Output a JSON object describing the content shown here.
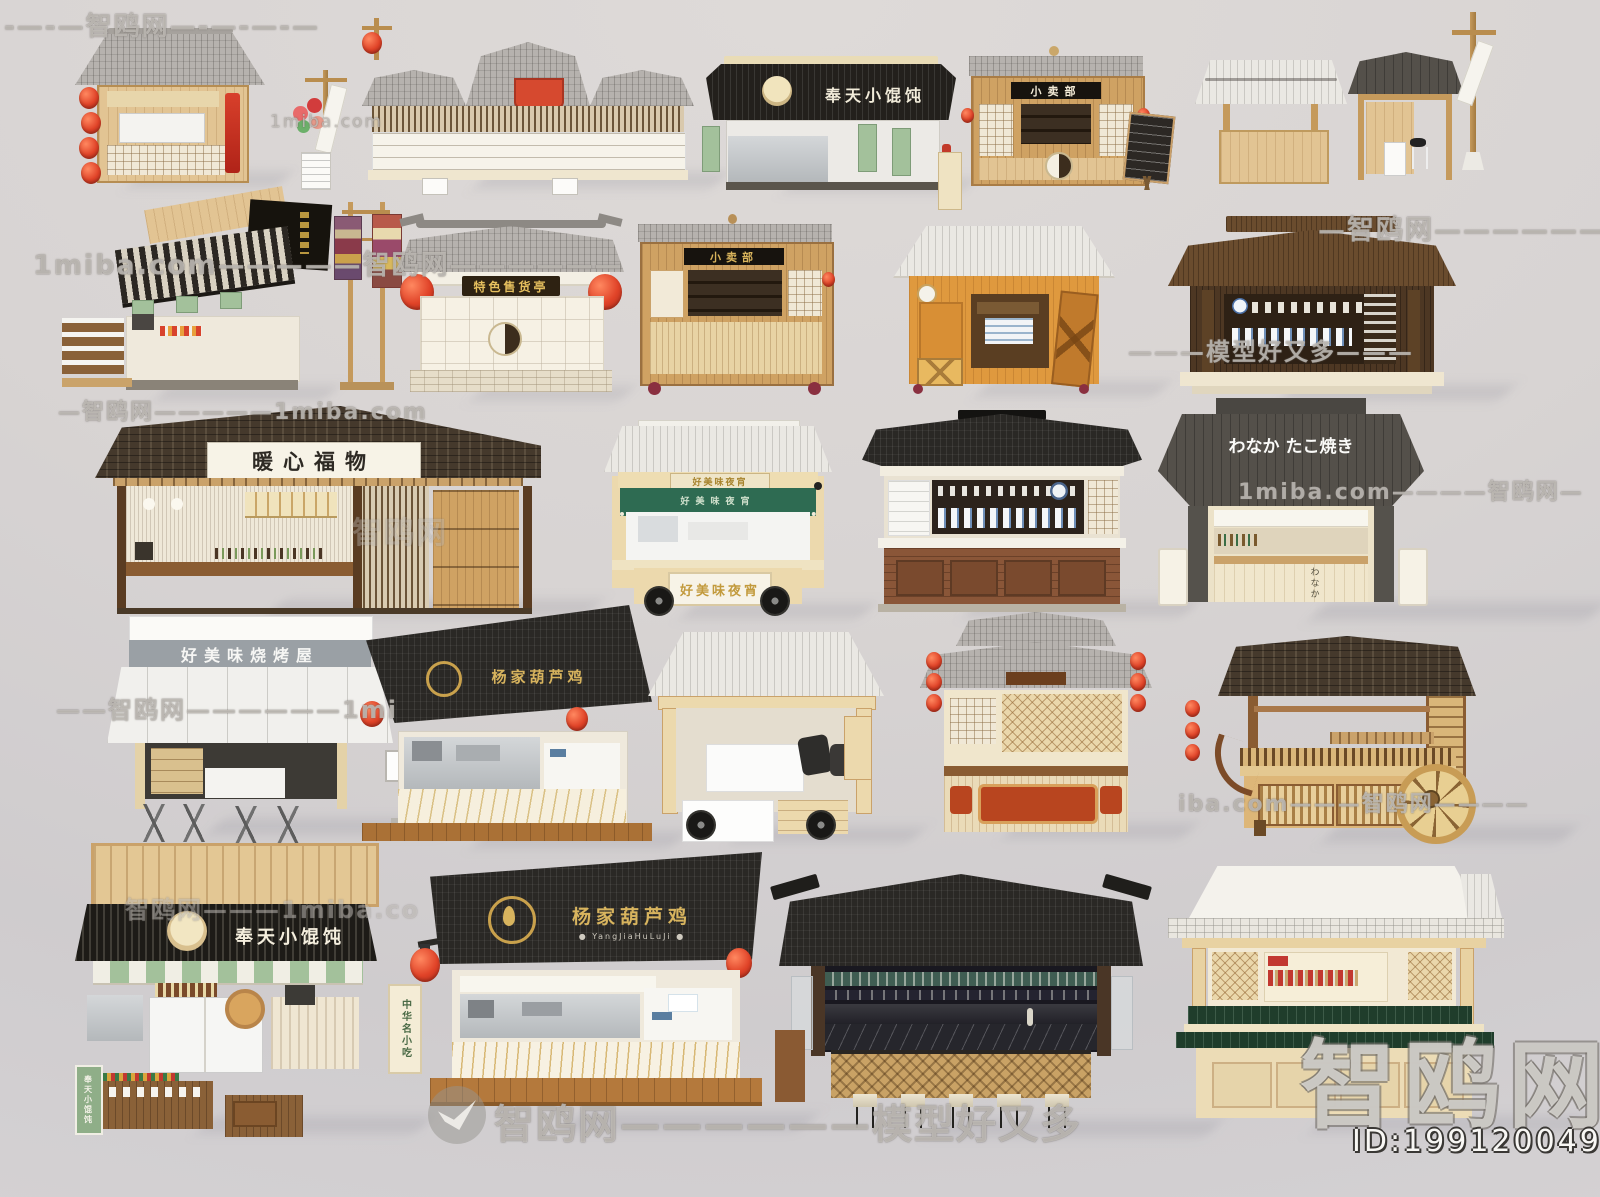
{
  "page": {
    "type": "3d-model-showcase",
    "subject": "Chinese street food stall and kiosk 3D models collection"
  },
  "watermarks": {
    "brand": "智鸥网",
    "site": "1miba.com",
    "slogan": "模型好又多",
    "model_id": "ID:199120049",
    "strips": [
      {
        "t": "-—-—智鸥网—-—-—-—"
      },
      {
        "t": "1miba.com—————智鸥网——————"
      },
      {
        "t": "—智鸥网——————"
      },
      {
        "t": "———模型好又多———"
      },
      {
        "t": "—智鸥网—————1miba.com"
      },
      {
        "t": "1miba.com————智鸥网—"
      },
      {
        "t": "——智鸥网——————1mi"
      },
      {
        "t": "iba.com———智鸥网————"
      },
      {
        "t": "智鸥网———1miba.co"
      },
      {
        "t": "智鸥网——————模型好又多"
      }
    ]
  },
  "stalls": [
    {
      "label": "wooden stall with red lanterns"
    },
    {
      "label": "balloon signpost with menu board"
    },
    {
      "label": "triple-roof shop with red sign"
    },
    {
      "sign": "奉天小馄饨",
      "label": "wonton kiosk with black awning"
    },
    {
      "sign": "小卖部",
      "label": "snack kiosk with bottle shelves"
    },
    {
      "label": "chalkboard menu stand"
    },
    {
      "label": "plain canopy stall"
    },
    {
      "label": "dark roof stall with stool"
    },
    {
      "label": "banner pole"
    },
    {
      "label": "striped awning food stall"
    },
    {
      "label": "tapestry banner stand"
    },
    {
      "sign": "特色售货亭",
      "label": "specialty goods kiosk"
    },
    {
      "sign": "小卖部",
      "label": "wooden bottle kiosk"
    },
    {
      "label": "orange cabin kiosk"
    },
    {
      "label": "dark tea pavilion with porcelain"
    },
    {
      "sign": "暖心福物",
      "label": "izakaya bar stall"
    },
    {
      "sign": "好美味夜宵",
      "label": "night snack food truck"
    },
    {
      "label": "black roof porcelain stall"
    },
    {
      "sign": "わなか たこ焼き",
      "sub": "わなか",
      "label": "takoyaki stand"
    },
    {
      "sign": "好美味烧烤屋",
      "label": "white awning bbq house"
    },
    {
      "sign": "杨家葫芦鸡",
      "label": "black roof chicken shop"
    },
    {
      "label": "open food cart with wheels"
    },
    {
      "label": "lattice window stall with lantern strings"
    },
    {
      "label": "wooden wheel cart"
    },
    {
      "sign": "奉天小馄饨",
      "side_sign": "中华名小吃",
      "label": "large wonton shop"
    },
    {
      "sign": "杨家葫芦鸡",
      "sub": "● YangJiaHuLuJi ●",
      "label": "huluji chicken shop"
    },
    {
      "label": "black bar pavilion with stools"
    },
    {
      "label": "light wood pavilion with green counters"
    }
  ]
}
